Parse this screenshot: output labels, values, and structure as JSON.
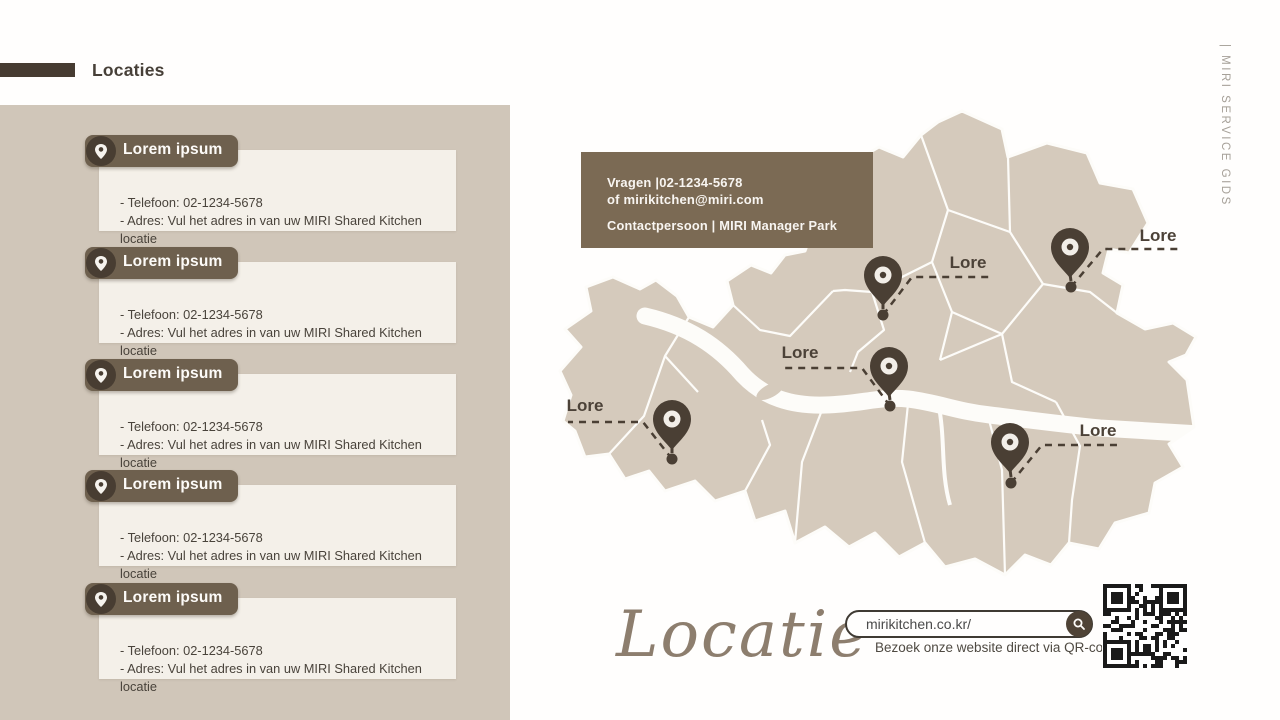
{
  "header": {
    "title": "Locaties"
  },
  "sidebar": {
    "cards": [
      {
        "title": "Lorem ipsum",
        "phone": "- Telefoon: 02-1234-5678",
        "address": "- Adres: Vul het adres in van uw MIRI Shared Kitchen locatie"
      },
      {
        "title": "Lorem ipsum",
        "phone": "- Telefoon: 02-1234-5678",
        "address": "- Adres: Vul het adres in van uw MIRI Shared Kitchen locatie"
      },
      {
        "title": "Lorem ipsum",
        "phone": "- Telefoon: 02-1234-5678",
        "address": "- Adres: Vul het adres in van uw MIRI Shared Kitchen locatie"
      },
      {
        "title": "Lorem ipsum",
        "phone": "- Telefoon: 02-1234-5678",
        "address": "- Adres: Vul het adres in van uw MIRI Shared Kitchen locatie"
      },
      {
        "title": "Lorem ipsum",
        "phone": "- Telefoon: 02-1234-5678",
        "address": "- Adres: Vul het adres in van uw MIRI Shared Kitchen locatie"
      }
    ]
  },
  "contact_box": {
    "line1": "Vragen |02-1234-5678",
    "line2": "of mirikitchen@miri.com",
    "line3": "Contactpersoon | MIRI Manager Park"
  },
  "map": {
    "pins": [
      {
        "label": "Lore",
        "head": [
          883,
          276
        ],
        "dot": [
          883,
          315
        ],
        "elbow": [
          912,
          277
        ],
        "end": [
          990,
          277
        ],
        "label_pos": [
          968,
          268
        ]
      },
      {
        "label": "Lore",
        "head": [
          1070,
          248
        ],
        "dot": [
          1071,
          287
        ],
        "elbow": [
          1103,
          249
        ],
        "end": [
          1178,
          249
        ],
        "label_pos": [
          1158,
          241
        ]
      },
      {
        "label": "Lore",
        "head": [
          889,
          367
        ],
        "dot": [
          890,
          406
        ],
        "elbow": [
          862,
          368
        ],
        "end": [
          785,
          368
        ],
        "label_pos": [
          800,
          358
        ]
      },
      {
        "label": "Lore",
        "head": [
          672,
          420
        ],
        "dot": [
          672,
          459
        ],
        "elbow": [
          643,
          422
        ],
        "end": [
          568,
          422
        ],
        "label_pos": [
          585,
          411
        ]
      },
      {
        "label": "Lore",
        "head": [
          1010,
          443
        ],
        "dot": [
          1011,
          483
        ],
        "elbow": [
          1042,
          445
        ],
        "end": [
          1117,
          445
        ],
        "label_pos": [
          1098,
          436
        ]
      }
    ]
  },
  "footer": {
    "script_title": "Locatie",
    "search_value": "mirikitchen.co.kr/",
    "qr_caption": "Bezoek onze website direct via QR-code! â-"
  },
  "side_label": {
    "text": "| MIRI SERVICE GIDS"
  },
  "colors": {
    "panel": "#d0c6b9",
    "card": "#f4f0e9",
    "ribbon": "#6e604e",
    "contact_box": "#7b6a54",
    "map_fill": "#d5cabc",
    "map_line": "#fdfcf9",
    "pin": "#4a3f34",
    "accent_dark": "#463b31"
  }
}
